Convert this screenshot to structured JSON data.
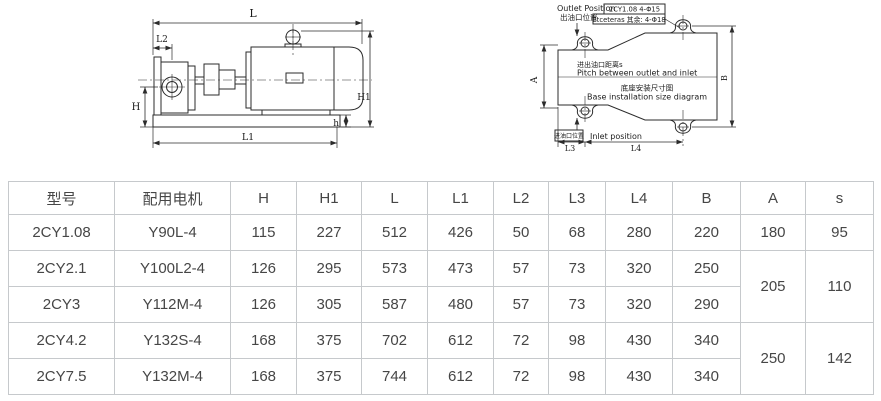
{
  "drawing_left": {
    "labels": {
      "L": "L",
      "L2": "L2",
      "H": "H",
      "H1": "H1",
      "h": "h",
      "L1": "L1"
    }
  },
  "drawing_right": {
    "outlet_en": "Outlet Position",
    "outlet_zh": "出油口位置",
    "note_line1": "2CY1.08  4-Φ15",
    "note_line2": "Etceteras 其余: 4-Φ18",
    "pitch_zh": "进出油口距离s",
    "pitch_en": "Pitch between outlet and inlet",
    "base_zh": "底座安装尺寸图",
    "base_en": "Base installation size diagram",
    "inlet_zh": "进油口位置",
    "inlet_en": "Inlet position",
    "labels": {
      "A": "A",
      "B": "B",
      "L3": "L3",
      "L4": "L4"
    }
  },
  "table": {
    "headers": [
      "型号",
      "配用电机",
      "H",
      "H1",
      "L",
      "L1",
      "L2",
      "L3",
      "L4",
      "B",
      "A",
      "s"
    ],
    "rows": [
      {
        "cells": [
          {
            "t": "2CY1.08"
          },
          {
            "t": "Y90L-4"
          },
          {
            "t": "115"
          },
          {
            "t": "227"
          },
          {
            "t": "512"
          },
          {
            "t": "426"
          },
          {
            "t": "50"
          },
          {
            "t": "68"
          },
          {
            "t": "280"
          },
          {
            "t": "220"
          },
          {
            "t": "180"
          },
          {
            "t": "95"
          }
        ]
      },
      {
        "cells": [
          {
            "t": "2CY2.1"
          },
          {
            "t": "Y100L2-4"
          },
          {
            "t": "126"
          },
          {
            "t": "295"
          },
          {
            "t": "573"
          },
          {
            "t": "473"
          },
          {
            "t": "57"
          },
          {
            "t": "73"
          },
          {
            "t": "320"
          },
          {
            "t": "250"
          },
          {
            "t": "205",
            "rs": 2
          },
          {
            "t": "110",
            "rs": 2
          }
        ]
      },
      {
        "cells": [
          {
            "t": "2CY3"
          },
          {
            "t": "Y112M-4"
          },
          {
            "t": "126"
          },
          {
            "t": "305"
          },
          {
            "t": "587"
          },
          {
            "t": "480"
          },
          {
            "t": "57"
          },
          {
            "t": "73"
          },
          {
            "t": "320"
          },
          {
            "t": "290"
          }
        ]
      },
      {
        "cells": [
          {
            "t": "2CY4.2"
          },
          {
            "t": "Y132S-4"
          },
          {
            "t": "168"
          },
          {
            "t": "375"
          },
          {
            "t": "702"
          },
          {
            "t": "612"
          },
          {
            "t": "72"
          },
          {
            "t": "98"
          },
          {
            "t": "430"
          },
          {
            "t": "340"
          },
          {
            "t": "250",
            "rs": 2
          },
          {
            "t": "142",
            "rs": 2
          }
        ]
      },
      {
        "cells": [
          {
            "t": "2CY7.5"
          },
          {
            "t": "Y132M-4"
          },
          {
            "t": "168"
          },
          {
            "t": "375"
          },
          {
            "t": "744"
          },
          {
            "t": "612"
          },
          {
            "t": "72"
          },
          {
            "t": "98"
          },
          {
            "t": "430"
          },
          {
            "t": "340"
          }
        ]
      }
    ]
  },
  "colors": {
    "line": "#2b2b2b",
    "table_border": "#c6c9cc",
    "table_text": "#464646"
  }
}
